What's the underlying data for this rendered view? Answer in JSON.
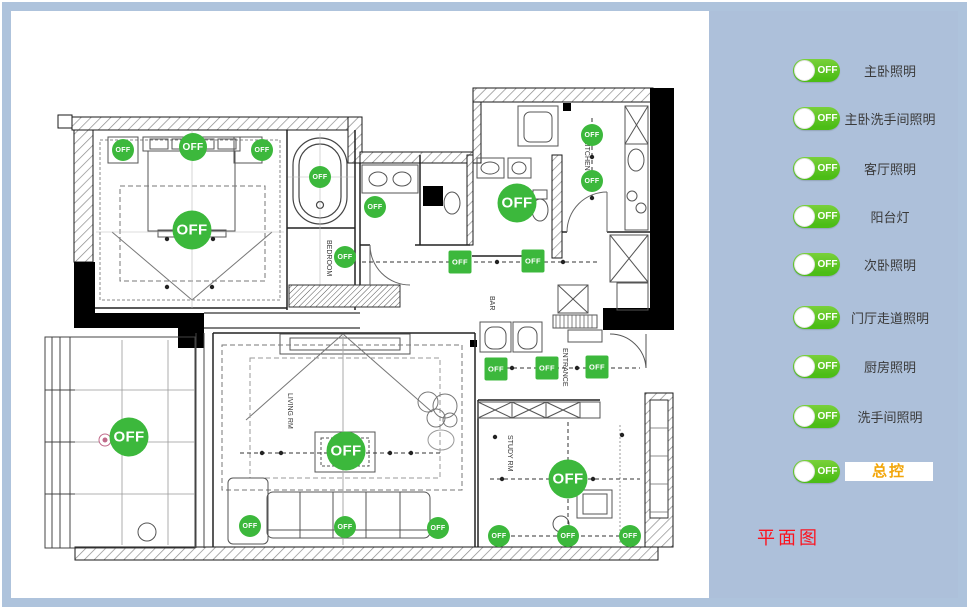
{
  "window": {
    "frame_color": "#aec3dc",
    "page_bg": "#ffffff"
  },
  "sidebar": {
    "bg_color": "#adc0da",
    "toggle_green": "#4cbd16",
    "toggles": [
      {
        "id": "master-bedroom-light",
        "label": "主卧照明",
        "state": "OFF",
        "highlight": false
      },
      {
        "id": "master-bathroom-light",
        "label": "主卧洗手间照明",
        "state": "OFF",
        "highlight": false
      },
      {
        "id": "living-room-light",
        "label": "客厅照明",
        "state": "OFF",
        "highlight": false
      },
      {
        "id": "balcony-light",
        "label": "阳台灯",
        "state": "OFF",
        "highlight": false
      },
      {
        "id": "second-bedroom-light",
        "label": "次卧照明",
        "state": "OFF",
        "highlight": false
      },
      {
        "id": "hallway-corridor-light",
        "label": "门厅走道照明",
        "state": "OFF",
        "highlight": false
      },
      {
        "id": "kitchen-light",
        "label": "厨房照明",
        "state": "OFF",
        "highlight": false
      },
      {
        "id": "bathroom-light",
        "label": "洗手间照明",
        "state": "OFF",
        "highlight": false
      },
      {
        "id": "master-switch",
        "label": "总控",
        "state": "OFF",
        "highlight": true
      }
    ],
    "highlight_text_color": "#f2a60a",
    "highlight_bg": "#ffffff",
    "caption": "平面图",
    "caption_color": "#fb1420"
  },
  "floorplan": {
    "button_color": "#3cb83c",
    "button_label": "OFF",
    "labels": {
      "kitchen": "KITCHEN",
      "entrance": "ENTRANCE",
      "study": "STUDY RM",
      "living": "LIVING RM",
      "bedroom": "BEDROOM",
      "bar": "BAR"
    },
    "buttons": [
      {
        "x": 123,
        "y": 150,
        "size": "sm",
        "shape": "circle"
      },
      {
        "x": 193,
        "y": 147,
        "size": "md",
        "shape": "circle"
      },
      {
        "x": 262,
        "y": 150,
        "size": "sm",
        "shape": "circle"
      },
      {
        "x": 192,
        "y": 230,
        "size": "lg",
        "shape": "circle"
      },
      {
        "x": 320,
        "y": 177,
        "size": "sm",
        "shape": "circle"
      },
      {
        "x": 375,
        "y": 207,
        "size": "sm",
        "shape": "circle"
      },
      {
        "x": 345,
        "y": 257,
        "size": "sm",
        "shape": "circle"
      },
      {
        "x": 517,
        "y": 203,
        "size": "lg",
        "shape": "circle"
      },
      {
        "x": 592,
        "y": 135,
        "size": "sm",
        "shape": "circle"
      },
      {
        "x": 592,
        "y": 181,
        "size": "sm",
        "shape": "circle"
      },
      {
        "x": 460,
        "y": 262,
        "size": "sq",
        "shape": "square"
      },
      {
        "x": 533,
        "y": 261,
        "size": "sq",
        "shape": "square"
      },
      {
        "x": 129,
        "y": 437,
        "size": "lg",
        "shape": "circle"
      },
      {
        "x": 346,
        "y": 451,
        "size": "lg",
        "shape": "circle"
      },
      {
        "x": 250,
        "y": 526,
        "size": "sm",
        "shape": "circle"
      },
      {
        "x": 345,
        "y": 527,
        "size": "sm",
        "shape": "circle"
      },
      {
        "x": 438,
        "y": 528,
        "size": "sm",
        "shape": "circle"
      },
      {
        "x": 496,
        "y": 369,
        "size": "sq",
        "shape": "square"
      },
      {
        "x": 547,
        "y": 368,
        "size": "sq",
        "shape": "square"
      },
      {
        "x": 597,
        "y": 367,
        "size": "sq",
        "shape": "square"
      },
      {
        "x": 568,
        "y": 479,
        "size": "lg",
        "shape": "circle"
      },
      {
        "x": 499,
        "y": 536,
        "size": "sm",
        "shape": "circle"
      },
      {
        "x": 568,
        "y": 536,
        "size": "sm",
        "shape": "circle"
      },
      {
        "x": 630,
        "y": 536,
        "size": "sm",
        "shape": "circle"
      }
    ]
  }
}
